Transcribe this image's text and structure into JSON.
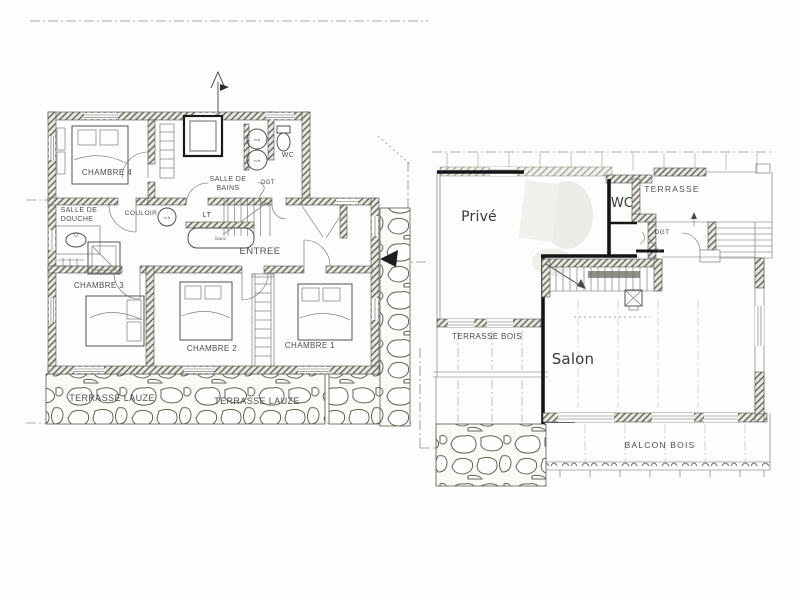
{
  "colors": {
    "paper": "#fdfdfc",
    "ink": "#4a4a4a",
    "bold_wall": "#151515",
    "label_scan": "#3f3e3c",
    "label_digital": "#36393d",
    "dash_line": "#8f8f8b"
  },
  "floor_upper": {
    "chambre4": "CHAMBRE 4",
    "salle_de_bains_l1": "SALLE DE",
    "salle_de_bains_l2": "BAINS",
    "wc": "WC",
    "dgt": "DGT",
    "salle_de_douche_l1": "SALLE DE",
    "salle_de_douche_l2": "DOUCHE",
    "couloir": "COULOIR",
    "lt": "LT",
    "rcb": "rcb",
    "banc": "banc",
    "entree": "ENTREE",
    "chambre3": "CHAMBRE 3",
    "chambre2": "CHAMBRE 2",
    "chambre1": "CHAMBRE 1",
    "terrasse_lauze_left": "TERRASSE LAUZE",
    "terrasse_lauze_right": "TERRASSE LAUZE"
  },
  "floor_main": {
    "prive": "Privé",
    "wc": "WC",
    "terrasse": "TERRASSE",
    "dgt": "DGT",
    "salon": "Salon",
    "terrasse_bois": "TERRASSE BOIS",
    "balcon_bois": "BALCON BOIS"
  }
}
